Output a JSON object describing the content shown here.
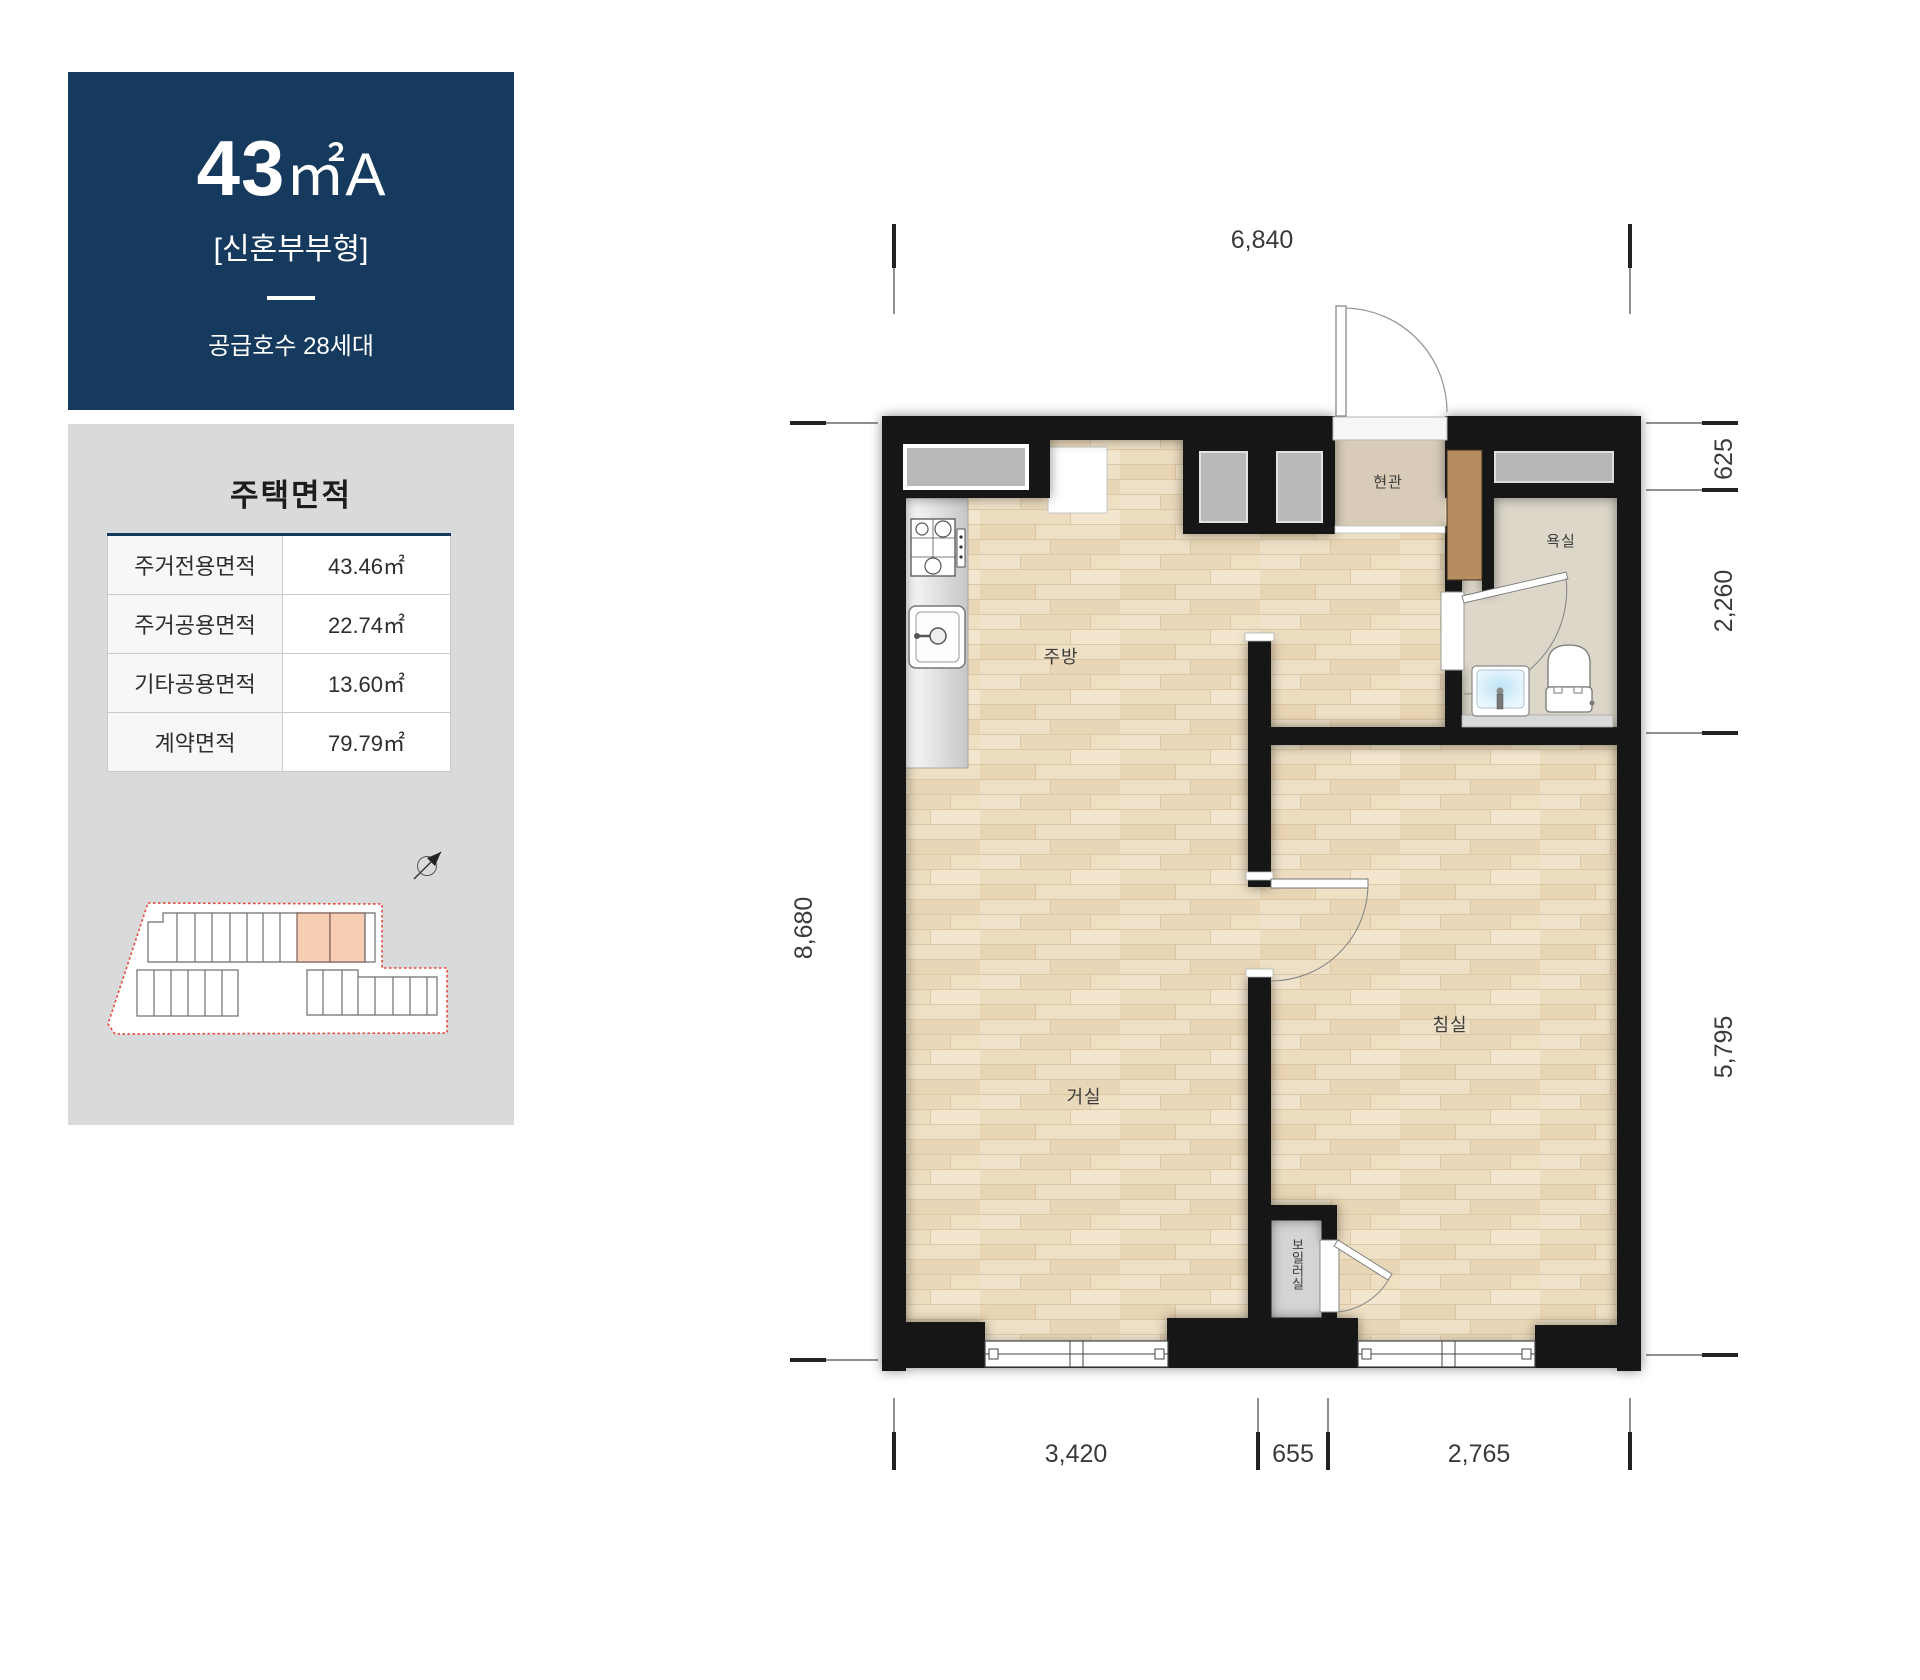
{
  "unit_card": {
    "size_number": "43",
    "size_suffix": "㎡A",
    "type_label": "[신혼부부형]",
    "supply_label": "공급호수 28세대"
  },
  "area_table": {
    "title": "주택면적",
    "rows": [
      {
        "label": "주거전용면적",
        "value": "43.46㎡"
      },
      {
        "label": "주거공용면적",
        "value": "22.74㎡"
      },
      {
        "label": "기타공용면적",
        "value": "13.60㎡"
      },
      {
        "label": "계약면적",
        "value": "79.79㎡"
      }
    ]
  },
  "site_plan": {
    "highlight_color": "#f7cdb4",
    "boundary_color": "#e8493a"
  },
  "floor_plan": {
    "rooms": {
      "kitchen": "주방",
      "living": "거실",
      "bedroom": "침실",
      "entrance": "현관",
      "bath": "욕실",
      "boiler": "보일러실"
    },
    "dims": {
      "top": "6,840",
      "left": "8,680",
      "right_top": "625",
      "right_mid": "2,260",
      "right_bottom": "5,795",
      "bottom_left": "3,420",
      "bottom_mid": "655",
      "bottom_right": "2,765"
    },
    "colors": {
      "wall": "#161616",
      "wood": "#ecdcc1",
      "tile_entrance": "#d8ccb8",
      "tile_bath": "#dcd7c9",
      "cabinet_brown": "#b68d5f",
      "navy": "#163a5e"
    }
  }
}
